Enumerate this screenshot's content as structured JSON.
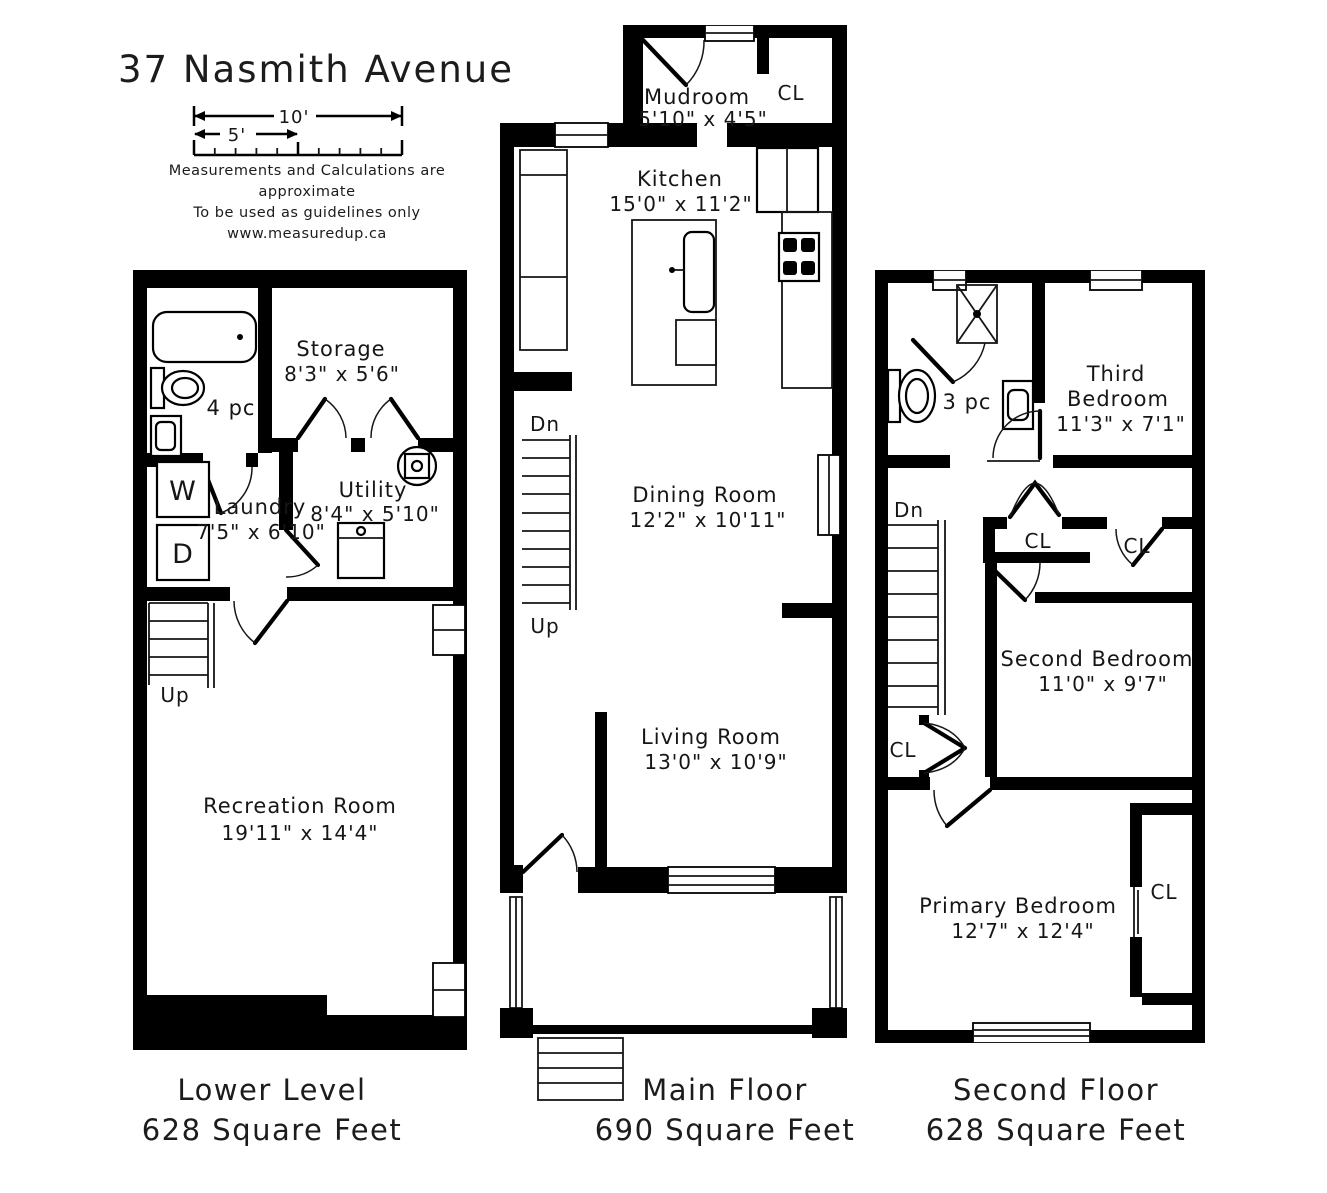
{
  "header": {
    "title": "37 Nasmith Avenue",
    "scale_label_10": "10'",
    "scale_label_5": "5'",
    "disclaimer": [
      "Measurements and Calculations are approximate",
      "To be used as guidelines only",
      "www.measuredup.ca"
    ]
  },
  "lower_level": {
    "caption": "Lower Level",
    "area": "628 Square Feet",
    "bath_label": "4 pc",
    "washer_label": "W",
    "dryer_label": "D",
    "stairs_up": "Up",
    "rooms": {
      "storage": {
        "name": "Storage",
        "dims": "8'3\" x 5'6\""
      },
      "laundry": {
        "name": "Laundry",
        "dims": "7'5\" x 6'10\""
      },
      "utility": {
        "name": "Utility",
        "dims": "8'4\" x 5'10\""
      },
      "recreation": {
        "name": "Recreation Room",
        "dims": "19'11\" x 14'4\""
      }
    }
  },
  "main_floor": {
    "caption": "Main Floor",
    "area": "690 Square Feet",
    "closet_label": "CL",
    "stairs_down": "Dn",
    "stairs_up": "Up",
    "rooms": {
      "mudroom": {
        "name": "Mudroom",
        "dims": "5'10\" x 4'5\""
      },
      "kitchen": {
        "name": "Kitchen",
        "dims": "15'0\" x 11'2\""
      },
      "dining": {
        "name": "Dining Room",
        "dims": "12'2\" x 10'11\""
      },
      "living": {
        "name": "Living Room",
        "dims": "13'0\" x 10'9\""
      }
    }
  },
  "second_floor": {
    "caption": "Second Floor",
    "area": "628 Square Feet",
    "bath_label": "3 pc",
    "stairs_down": "Dn",
    "closet_label": "CL",
    "rooms": {
      "third_bedroom": {
        "name_line1": "Third",
        "name_line2": "Bedroom",
        "dims": "11'3\" x 7'1\""
      },
      "second_bedroom": {
        "name": "Second Bedroom",
        "dims": "11'0\" x 9'7\""
      },
      "primary_bedroom": {
        "name": "Primary Bedroom",
        "dims": "12'7\" x 12'4\""
      }
    }
  },
  "colors": {
    "wall": "#000000",
    "background": "#ffffff",
    "text": "#161616"
  }
}
